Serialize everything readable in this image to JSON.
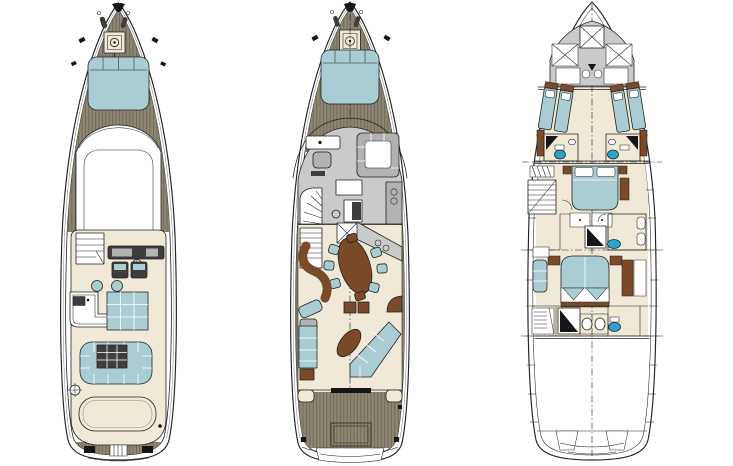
{
  "palette": {
    "line": "#222222",
    "soft_line": "#8c8c8c",
    "teak": "#8d8673",
    "teak_line": "#645e4c",
    "cream": "#f0e9d7",
    "upholstery_blue": "#a9cdd3",
    "fixture_blue": "#2ba3cb",
    "wood_brown": "#7b4a28",
    "zone_grey": "#cacaca",
    "furniture_grey": "#b2b2b2",
    "console_dark": "#3d3d3d",
    "black": "#161616"
  },
  "diagram": {
    "type": "yacht-deck-plan-triptych",
    "views": [
      {
        "id": "flybridge-plan",
        "features": [
          "bow sunpad",
          "anchor windlass",
          "bow cleats",
          "hardtop arch",
          "stairs",
          "helm console",
          "steering wheel",
          "helm seats",
          "bar stools",
          "wet bar with sink",
          "gridded sunbed",
          "u-shaped sofa with table",
          "pedestal table",
          "aft oval sunpad",
          "stern teak platform"
        ]
      },
      {
        "id": "main-deck-plan",
        "features": [
          "bow sunpad",
          "anchor windlass",
          "bow cleats",
          "windshield",
          "helm station",
          "pilothouse settee",
          "spiral staircase",
          "galley counters",
          "stove",
          "stairs",
          "dining table with chairs",
          "curved bar",
          "chaise seat",
          "sideboard",
          "salon sofa port",
          "salon sectional starboard",
          "coffee table",
          "aft doorway",
          "cockpit teak deck",
          "cockpit hatch",
          "transom steps"
        ]
      },
      {
        "id": "lower-deck-plan",
        "features": [
          "forepeak",
          "crew lockers",
          "crew cabin",
          "guest cabin port twin beds",
          "guest cabin starboard twin beds",
          "guest head port",
          "guest head starboard",
          "toilets",
          "stairs",
          "vip double bed",
          "dressers",
          "shower",
          "mid bathroom",
          "master double bed",
          "master sofa",
          "nightstands",
          "wardrobe",
          "master bathroom twin sinks",
          "master shower",
          "master toilet",
          "engine room",
          "transom platform"
        ]
      }
    ]
  }
}
